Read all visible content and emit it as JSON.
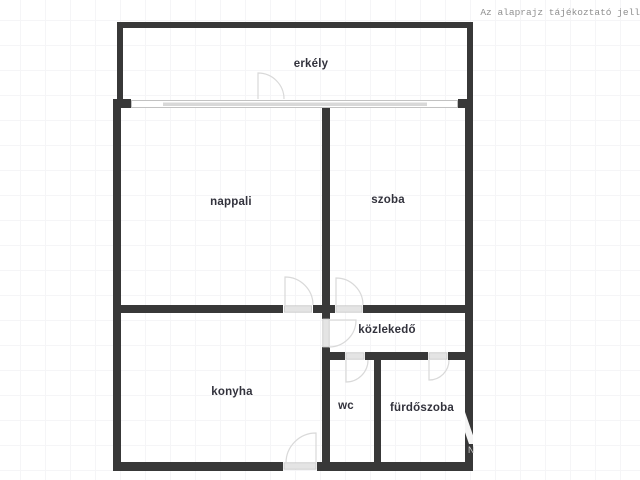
{
  "disclaimer": "Az alaprajz tájékoztató jell",
  "floorplan": {
    "rooms": [
      {
        "name": "erkely",
        "label": "erkély"
      },
      {
        "name": "nappali",
        "label": "nappali"
      },
      {
        "name": "szoba",
        "label": "szoba"
      },
      {
        "name": "kozlekedo",
        "label": "közlekedő"
      },
      {
        "name": "konyha",
        "label": "konyha"
      },
      {
        "name": "wc",
        "label": "wc"
      },
      {
        "name": "furdoszoba",
        "label": "fürdőszoba"
      }
    ],
    "colors": {
      "wall": "#383838",
      "door_leaf": "#e4e4e4",
      "door_arc": "#d9d9d9",
      "window_glass": "#d8d8d8",
      "background_grid": "#f5f5f7",
      "room_label_text": "#32323c",
      "disclaimer_text": "#8f8f8f"
    }
  },
  "watermark": {
    "letter": "N"
  }
}
